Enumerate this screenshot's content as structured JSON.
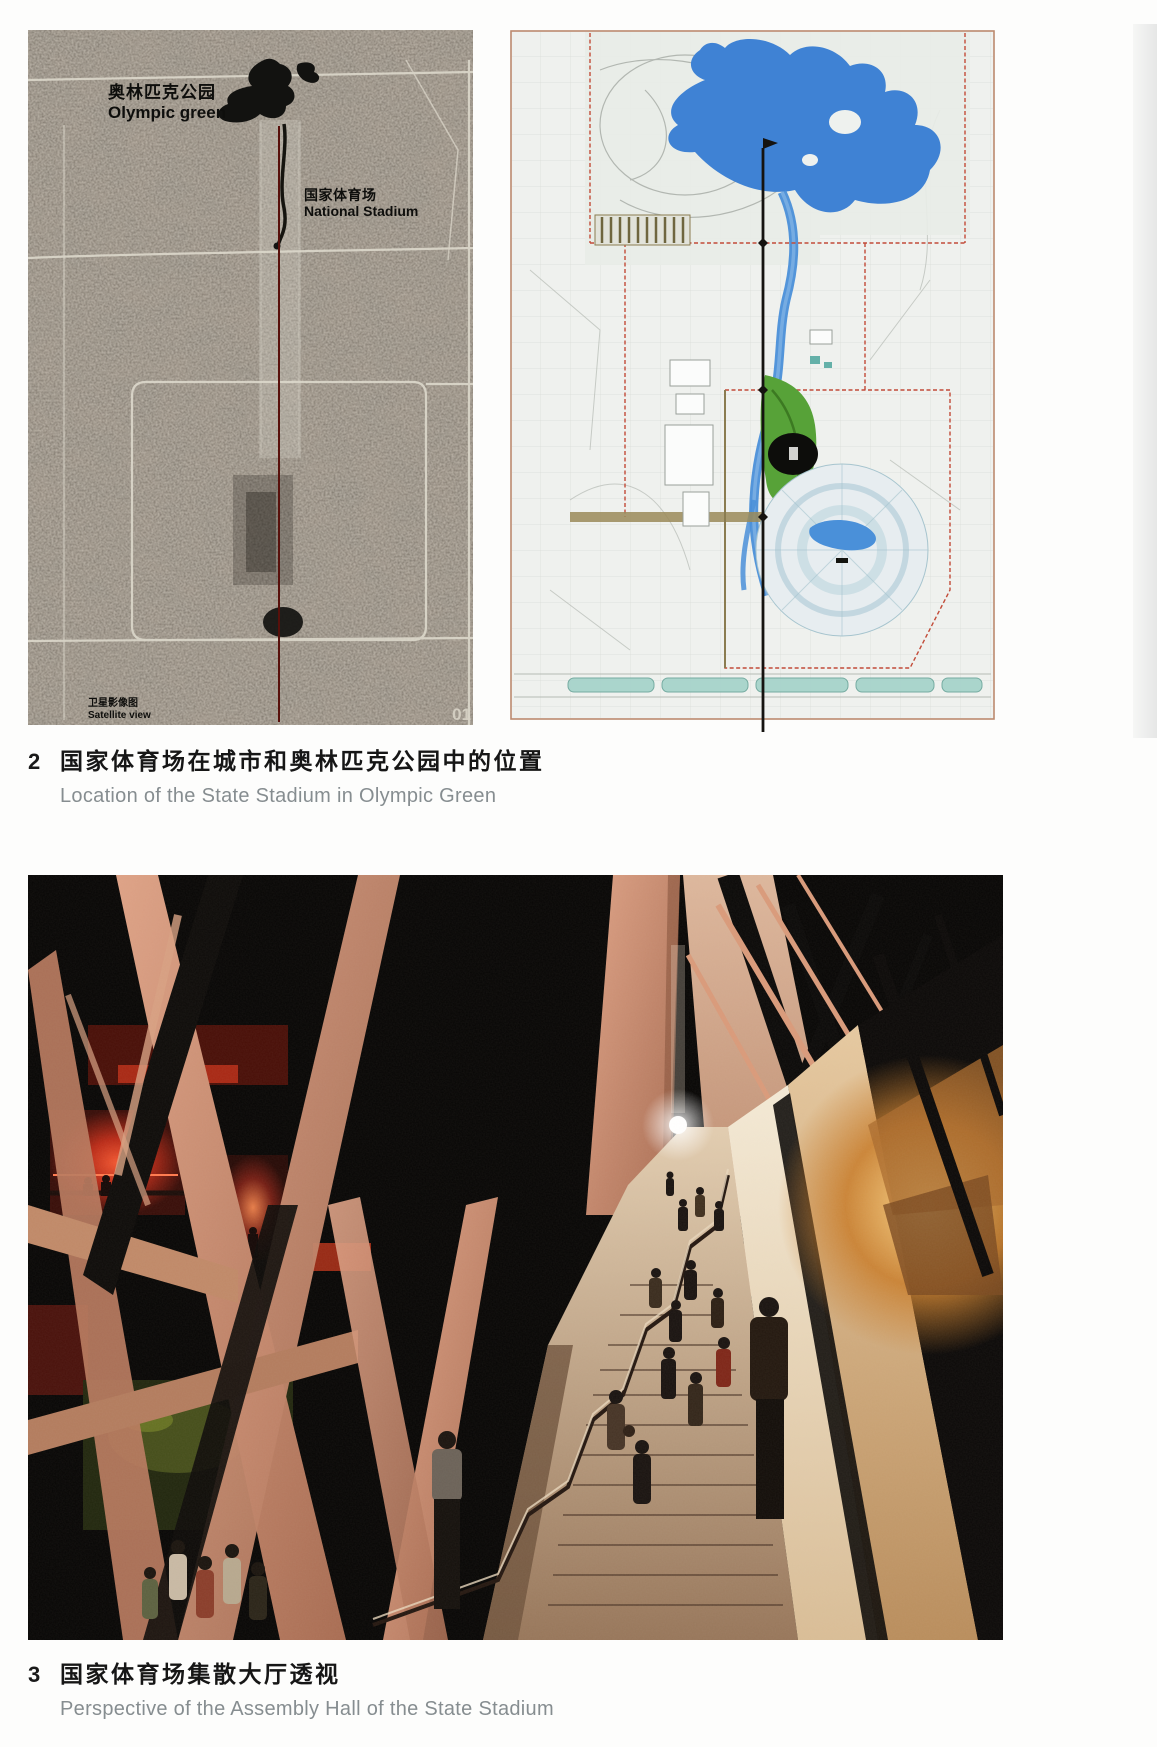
{
  "figure2": {
    "number": "2",
    "caption_zh": "国家体育场在城市和奥林匹克公园中的位置",
    "caption_en": "Location of the State Stadium in Olympic Green"
  },
  "figure3": {
    "number": "3",
    "caption_zh": "国家体育场集散大厅透视",
    "caption_en": "Perspective of the Assembly Hall of the State Stadium"
  },
  "satellite": {
    "park_zh": "奥林匹克公园",
    "park_en": "Olympic green",
    "stadium_zh": "国家体育场",
    "stadium_en": "National Stadium",
    "source_zh": "卫星影像图",
    "source_en": "Satellite view",
    "page_mark": "01"
  },
  "colors": {
    "satellite_base": "#6b645a",
    "satellite_axis_red": "#58100b",
    "map_lake_blue": "#3f82d4",
    "map_green_park": "#57a238",
    "map_boundary_red": "#c24b38",
    "photo_beam_salmon": "#c98970",
    "photo_red_glow": "#c22c18",
    "photo_cream": "#e9dcc4",
    "caption_gray": "#868d90"
  }
}
